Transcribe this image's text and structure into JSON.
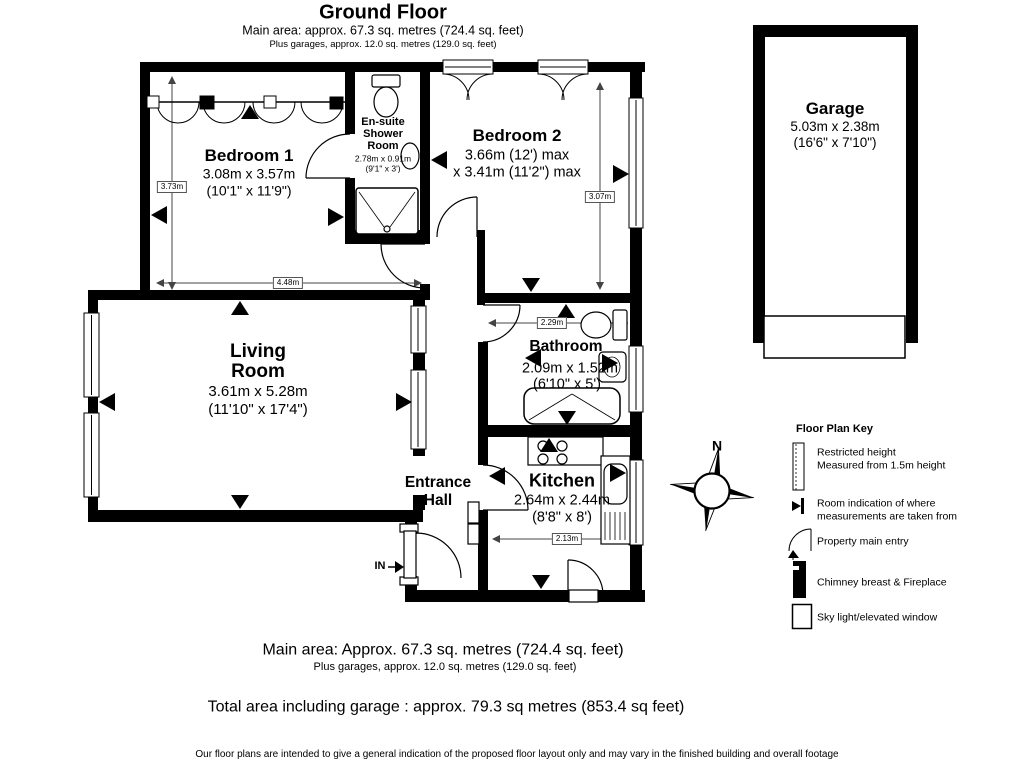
{
  "header": {
    "title": "Ground Floor",
    "subtitle": "Main area: approx. 67.3 sq. metres (724.4 sq. feet)",
    "subtitle2": "Plus garages, approx. 12.0 sq. metres (129.0 sq. feet)"
  },
  "rooms": {
    "bedroom1": {
      "name": "Bedroom 1",
      "dims_m": "3.08m x 3.57m",
      "dims_ft": "(10'1\" x 11'9\")"
    },
    "ensuite": {
      "name1": "En-suite",
      "name2": "Shower",
      "name3": "Room",
      "dims_m": "2.78m x 0.91m",
      "dims_ft": "(9'1\" x 3')"
    },
    "bedroom2": {
      "name": "Bedroom 2",
      "dims1": "3.66m (12') max",
      "dims2": "x 3.41m (11'2\") max"
    },
    "living": {
      "name1": "Living",
      "name2": "Room",
      "dims_m": "3.61m x 5.28m",
      "dims_ft": "(11'10\" x 17'4\")"
    },
    "bathroom": {
      "name": "Bathroom",
      "dims_m": "2.09m x 1.52m",
      "dims_ft": "(6'10\" x 5')"
    },
    "entrance": {
      "name1": "Entrance",
      "name2": "Hall"
    },
    "kitchen": {
      "name": "Kitchen",
      "dims_m": "2.64m x 2.44m",
      "dims_ft": "(8'8\" x 8')"
    },
    "garage": {
      "name": "Garage",
      "dims_m": "5.03m x 2.38m",
      "dims_ft": "(16'6\" x 7'10\")"
    }
  },
  "dimension_labels": {
    "bed1_vertical": "3.73m",
    "bed1_horizontal": "4.48m",
    "bed2_vertical": "3.07m",
    "bathroom_width": "2.29m",
    "kitchen_width": "2.13m"
  },
  "labels": {
    "entry": "IN",
    "north": "N"
  },
  "key": {
    "title": "Floor Plan Key",
    "items": [
      {
        "icon": "restricted-height-icon",
        "line1": "Restricted height",
        "line2": "Measured from 1.5m height"
      },
      {
        "icon": "measurement-origin-icon",
        "line1": "Room indication of where",
        "line2": "measurements are taken from"
      },
      {
        "icon": "main-entry-icon",
        "line1": "Property main entry",
        "line2": ""
      },
      {
        "icon": "chimney-icon",
        "line1": "Chimney breast & Fireplace",
        "line2": ""
      },
      {
        "icon": "skylight-icon",
        "line1": "Sky light/elevated window",
        "line2": ""
      }
    ]
  },
  "footer": {
    "main": "Main area: Approx. 67.3 sq. metres (724.4 sq. feet)",
    "sub": "Plus garages, approx. 12.0 sq. metres (129.0 sq. feet)",
    "total": "Total area including garage : approx. 79.3 sq metres (853.4 sq feet)",
    "disclaimer": "Our floor plans are intended to give a general indication of the proposed floor layout only and may vary in the finished building and overall footage"
  },
  "colors": {
    "wall": "#000000",
    "background": "#ffffff",
    "line": "#444444"
  }
}
